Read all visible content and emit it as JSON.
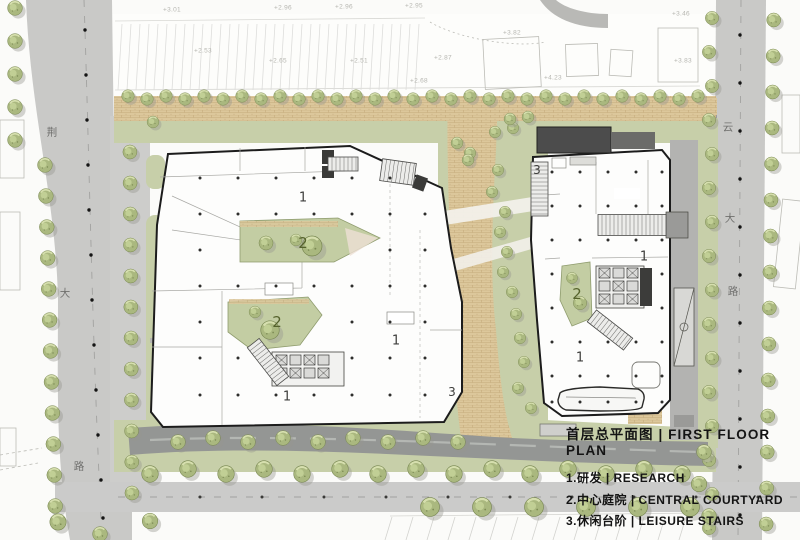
{
  "drawing": {
    "title_zh": "首层总平面图",
    "title_en": "FIRST FLOOR PLAN",
    "title_full": "首层总平面图 | FIRST FLOOR PLAN"
  },
  "legend": {
    "title": "首层总平面图 | FIRST FLOOR PLAN",
    "items": [
      {
        "num": "1",
        "zh": "研发",
        "en": "RESEARCH",
        "label": "1.研发 | RESEARCH"
      },
      {
        "num": "2",
        "zh": "中心庭院",
        "en": "CENTRAL COURTYARD",
        "label": "2.中心庭院 | CENTRAL COURTYARD"
      },
      {
        "num": "3",
        "zh": "休闲台阶",
        "en": "LEISURE STAIRS",
        "label": "3.休闲台阶 | LEISURE STAIRS"
      }
    ]
  },
  "roads": {
    "west": {
      "name": "荆大路",
      "chars": [
        "荆",
        "大",
        "路"
      ]
    },
    "east": {
      "name": "云大路",
      "chars": [
        "云",
        "大",
        "路"
      ]
    }
  },
  "zones": [
    {
      "n": "1"
    },
    {
      "n": "2"
    },
    {
      "n": "2"
    },
    {
      "n": "1"
    },
    {
      "n": "1"
    },
    {
      "n": "3"
    },
    {
      "n": "3"
    },
    {
      "n": "1"
    },
    {
      "n": "2"
    },
    {
      "n": "1"
    }
  ],
  "levels": [
    "+3.01",
    "+2.96",
    "+2.96",
    "+2.53",
    "+2.65",
    "+2.51",
    "+2.95",
    "+2.68",
    "+2.87",
    "+3.82",
    "+4.23",
    "+3.46",
    "+3.83"
  ],
  "colors": {
    "road": "#c9c9c7",
    "asphalt": "#949694",
    "paving": "#dcc79b",
    "landscape": "#c7cfa9",
    "tree": "#aab87f",
    "building_outline": "#1c1c1c",
    "canopy": "#4c4c4c",
    "legend_text": "#141414",
    "courtyard_number": "#55622c"
  }
}
